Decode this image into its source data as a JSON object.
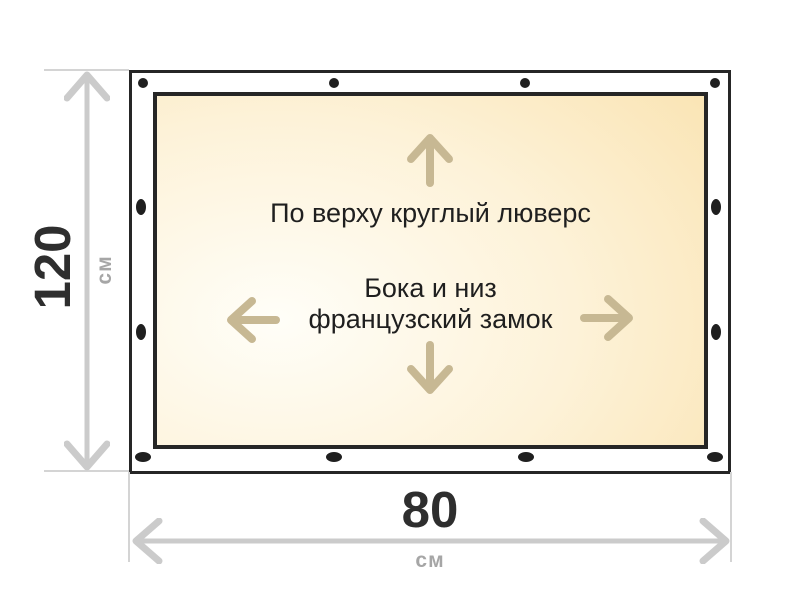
{
  "diagram": {
    "print_area": {
      "top_note": "По верху круглый люверс",
      "side_note_line1": "Бока и низ",
      "side_note_line2": "французский замок"
    },
    "dimensions": {
      "height": {
        "value": "120",
        "unit": "см"
      },
      "width": {
        "value": "80",
        "unit": "см"
      }
    },
    "icons": {
      "grommet": "grommet-dot",
      "fixation_arrows": [
        "arrow-up-icon",
        "arrow-left-icon",
        "arrow-right-icon",
        "arrow-down-icon"
      ],
      "dimension_arrows": [
        "height-dimension-arrow-icon",
        "width-dimension-arrow-icon"
      ]
    },
    "colors": {
      "ink": "#262626",
      "grommet": "#1f1f1f",
      "note_text": "#1f1f1f",
      "dimension_line": "#cbcbcb",
      "dimension_number": "#2e2e2e",
      "dimension_unit_text": "#a6a6a6",
      "fixation_arrow": "#c7b893",
      "banner_fill_light": "#fffef8",
      "banner_fill_mid": "#fdf2d8",
      "banner_fill_dark": "#f9e0a9"
    }
  }
}
